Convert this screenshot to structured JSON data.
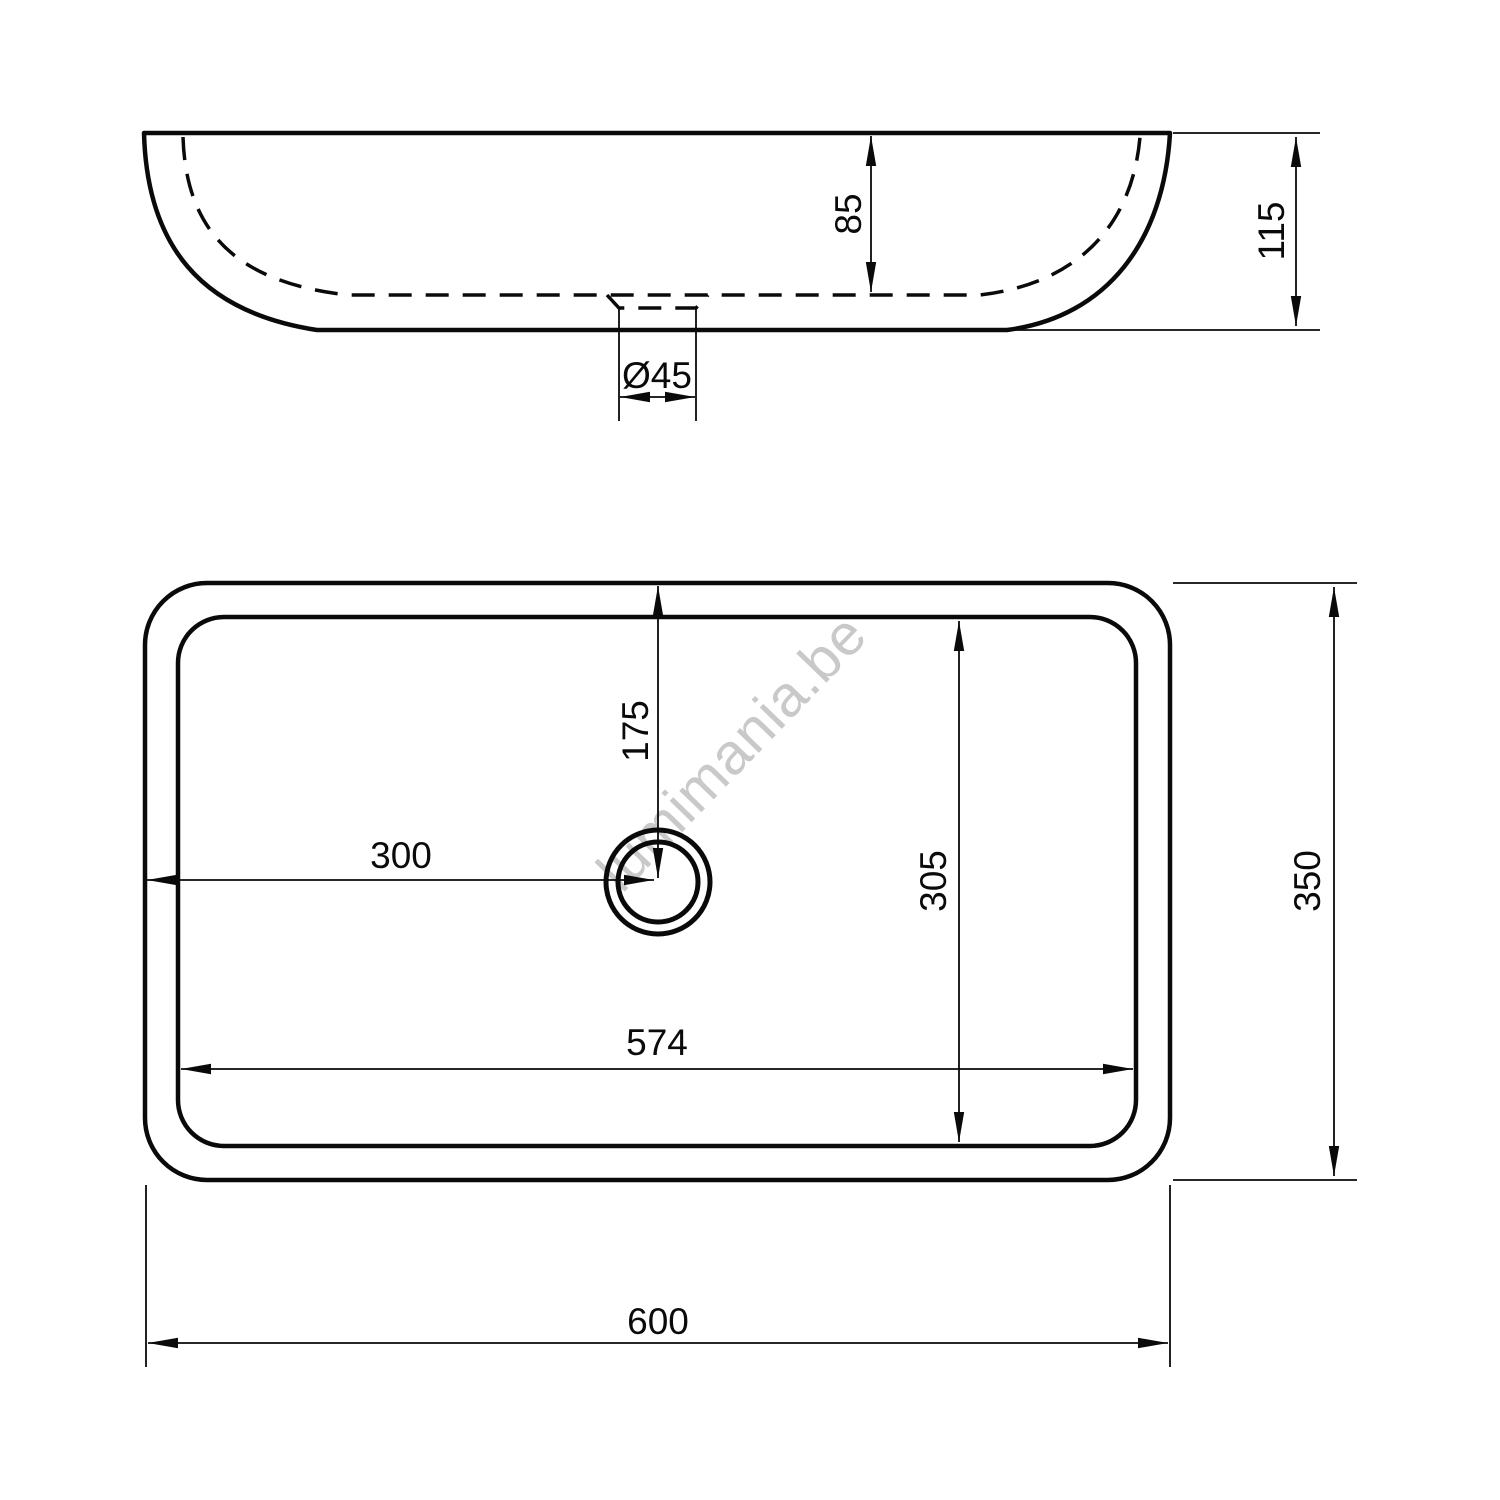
{
  "canvas": {
    "width": "1500",
    "height": "1500",
    "background": "#ffffff",
    "line_color": "#0a0a0a",
    "watermark_color": "#c9c9c9"
  },
  "watermark": {
    "text": "lumimania.be"
  },
  "side_view": {
    "label": "washbasin side elevation",
    "dimensions": {
      "inner_depth": "85",
      "overall_height": "115",
      "drain_diameter": "Ø45"
    }
  },
  "plan_view": {
    "label": "washbasin plan view",
    "dimensions": {
      "drain_center_from_top": "175",
      "drain_center_from_left": "300",
      "inner_basin_width": "305",
      "inner_basin_length": "574",
      "overall_depth": "350",
      "overall_length": "600"
    }
  }
}
